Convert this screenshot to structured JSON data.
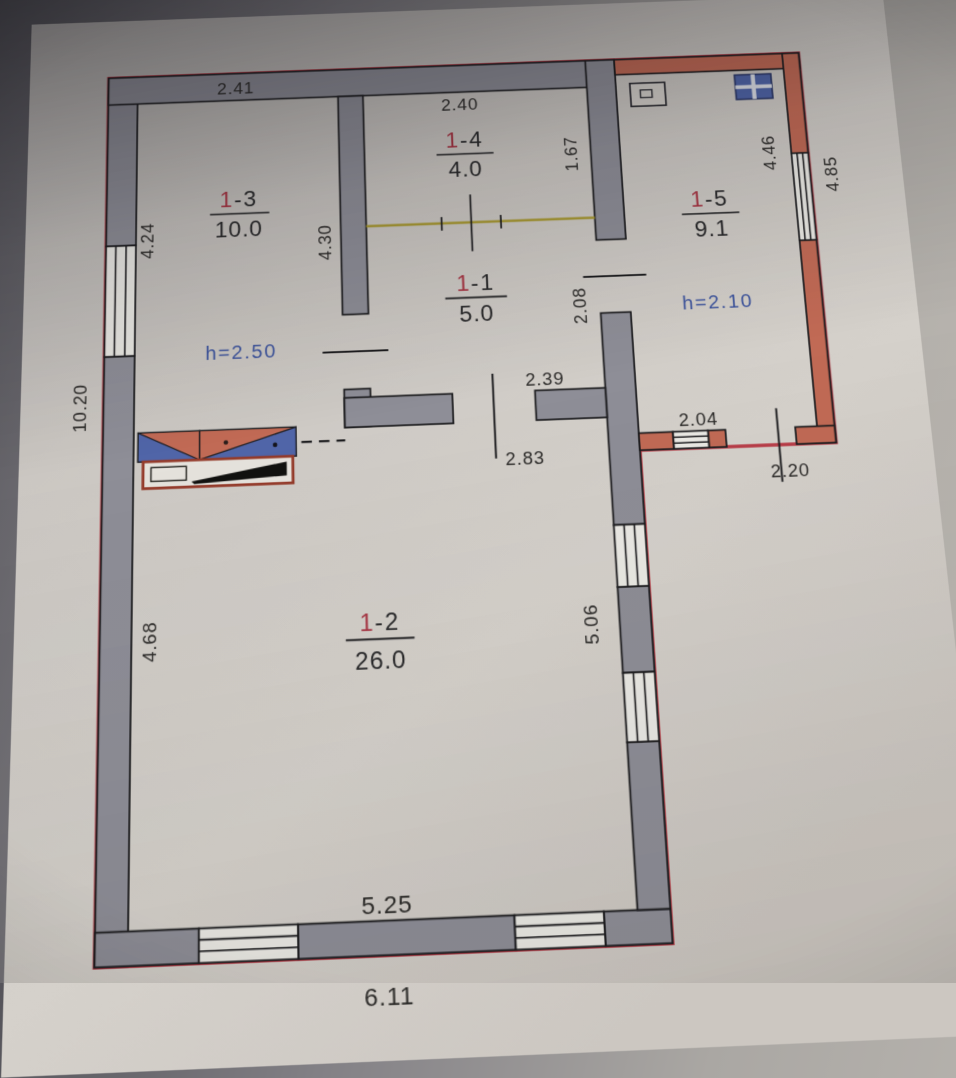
{
  "plan": {
    "kind": "floor-plan-photo",
    "rooms": [
      {
        "id": "room-1-3",
        "number_prefix": "1",
        "number_suffix": "-3",
        "area": "10.0",
        "height_note": "h=2.50"
      },
      {
        "id": "room-1-4",
        "number_prefix": "1",
        "number_suffix": "-4",
        "area": "4.0"
      },
      {
        "id": "room-1-1",
        "number_prefix": "1",
        "number_suffix": "-1",
        "area": "5.0"
      },
      {
        "id": "room-1-2",
        "number_prefix": "1",
        "number_suffix": "-2",
        "area": "26.0"
      },
      {
        "id": "room-1-5",
        "number_prefix": "1",
        "number_suffix": "-5",
        "area": "9.1",
        "height_note": "h=2.10"
      }
    ],
    "dimensions": {
      "room13_top": "2.41",
      "room13_left": "4.24",
      "midwall_left": "4.30",
      "room14_top": "2.40",
      "room14_right": "1.67",
      "room11_right": "2.08",
      "room11_bottom": "2.39",
      "room12_top": "2.83",
      "outer_left": "10.20",
      "room12_left": "4.68",
      "room12_right": "5.06",
      "room12_bottom": "5.25",
      "outer_bottom": "6.11",
      "annex_bottom_inner": "2.04",
      "annex_bottom_outer": "2.20",
      "annex_right_inner": "4.46",
      "annex_right_outer": "4.85"
    },
    "colors": {
      "wall_grey": "#8f8f99",
      "annex_wall_red": "#c96a52",
      "outer_edge_red": "#c23a46",
      "partition_yellow": "#ac9c2e",
      "room_number_red": "#b03343",
      "height_note_blue": "#3c55a5",
      "paper": "#cfccc6",
      "stove_blue": "#4f66b0",
      "ink": "#2e2c2a"
    },
    "icons": [
      "stove-symbol",
      "sink-icon",
      "stove-icon",
      "window-symbol",
      "door-opening"
    ]
  }
}
